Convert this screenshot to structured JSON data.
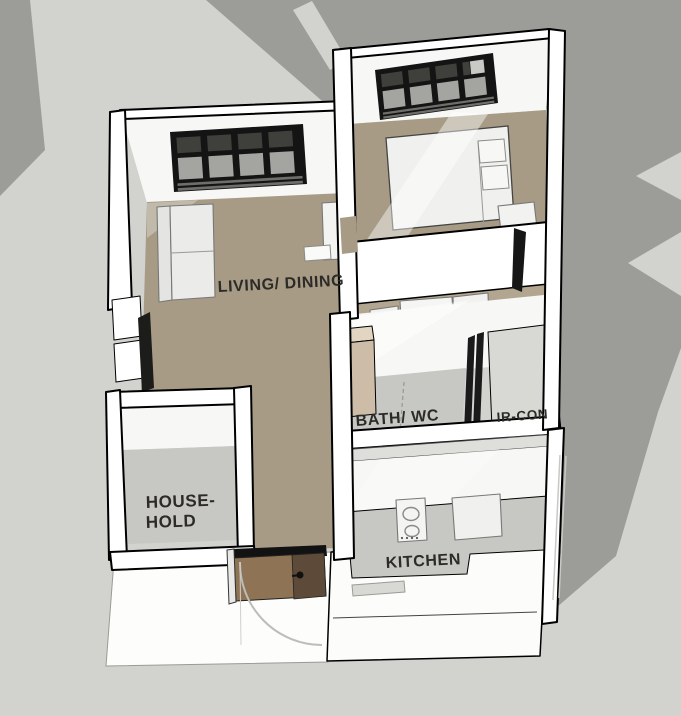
{
  "scene": {
    "type": "3d-floor-plan-render",
    "description": "Axonometric cutaway render of a small apartment with cast shadows",
    "labels": {
      "living": "LIVING/ DINING",
      "household_line1": "HOUSE-",
      "household_line2": "HOLD",
      "bath": "BATH/ WC",
      "aircon": "IR-CON",
      "kitchen": "KITCHEN"
    },
    "colors": {
      "background": "#d2d2ce",
      "shadow": "#9c9c98",
      "wall": "#ffffff",
      "wall_face": "#f7f7f5",
      "wall_top": "#dededa",
      "floor_tan": "#a79b86",
      "floor_tan_light": "#b3a690",
      "floor_gray": "#c7c7c3",
      "floor_light_gray": "#d8d8d4",
      "window_frame": "#141414",
      "window_pane": "#a4a4a0",
      "window_pane_dark": "#3f3f3b",
      "door_brown": "#8f7355",
      "door_brown_dark": "#5e4a38",
      "vanity_wood": "#cdbda8",
      "vanity_wood_top": "#e2d6c2",
      "vanity_wood_dark": "#8d7a62",
      "furniture_white": "#f1f1ef",
      "label_text": "#2d2b27",
      "swing_arc": "#bcbcb8"
    }
  }
}
